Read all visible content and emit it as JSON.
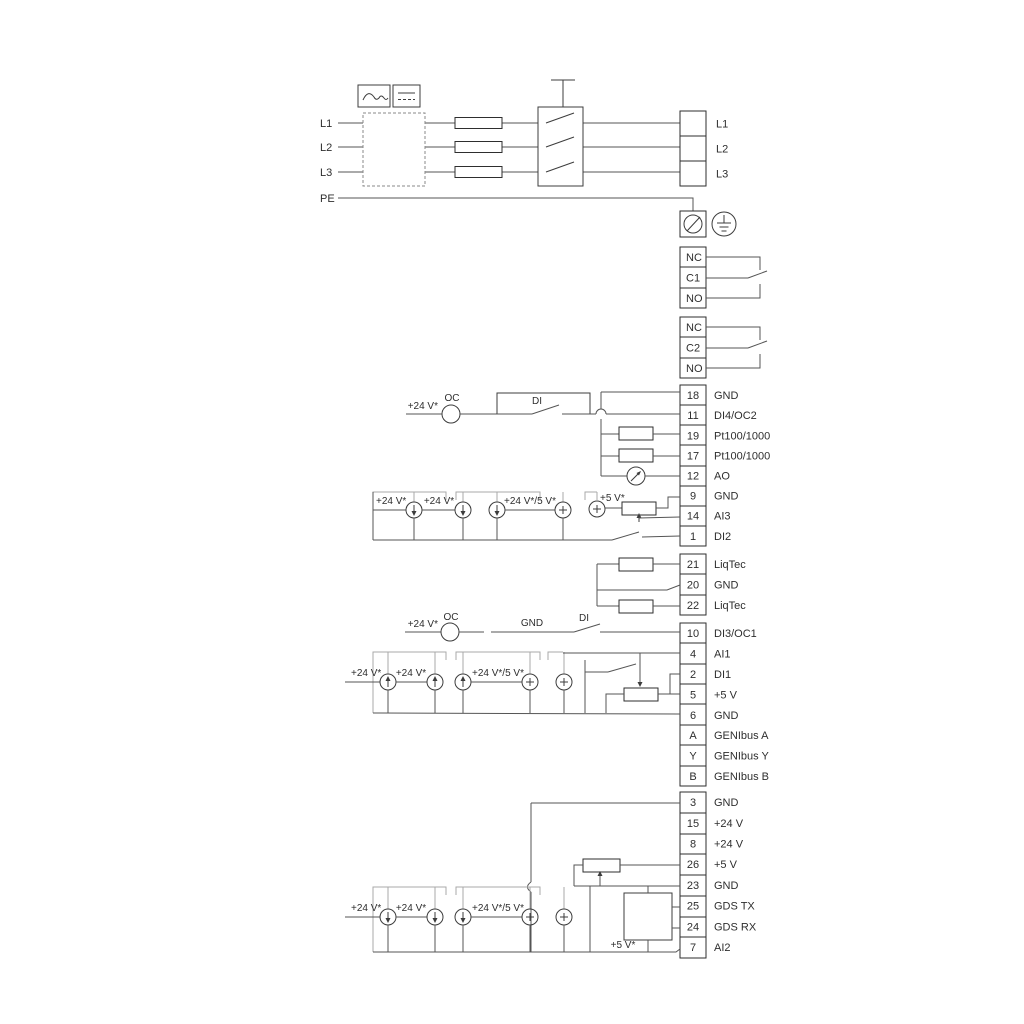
{
  "colors": {
    "background": "#ffffff",
    "wire": "#555555",
    "rail": "#a9a9a9",
    "text": "#2e2e2e"
  },
  "power": {
    "left_labels": [
      "L1",
      "L2",
      "L3",
      "PE"
    ],
    "mains_terminal_labels": [
      "L1",
      "L2",
      "L3"
    ]
  },
  "relay1": {
    "pins": [
      "NC",
      "C1",
      "NO"
    ]
  },
  "relay2": {
    "pins": [
      "NC",
      "C2",
      "NO"
    ]
  },
  "io_top": {
    "rows": [
      {
        "pin": "18",
        "label": "GND"
      },
      {
        "pin": "11",
        "label": "DI4/OC2"
      },
      {
        "pin": "19",
        "label": "Pt100/1000"
      },
      {
        "pin": "17",
        "label": "Pt100/1000"
      },
      {
        "pin": "12",
        "label": "AO"
      },
      {
        "pin": "9",
        "label": "GND"
      },
      {
        "pin": "14",
        "label": "AI3"
      },
      {
        "pin": "1",
        "label": "DI2"
      }
    ]
  },
  "liqtec": {
    "rows": [
      {
        "pin": "21",
        "label": "LiqTec"
      },
      {
        "pin": "20",
        "label": "GND"
      },
      {
        "pin": "22",
        "label": "LiqTec"
      }
    ]
  },
  "io_mid": {
    "rows": [
      {
        "pin": "10",
        "label": "DI3/OC1"
      },
      {
        "pin": "4",
        "label": "AI1"
      },
      {
        "pin": "2",
        "label": "DI1"
      },
      {
        "pin": "5",
        "label": "+5 V"
      },
      {
        "pin": "6",
        "label": "GND"
      },
      {
        "pin": "A",
        "label": "GENIbus A"
      },
      {
        "pin": "Y",
        "label": "GENIbus Y"
      },
      {
        "pin": "B",
        "label": "GENIbus B"
      }
    ]
  },
  "io_bottom": {
    "rows": [
      {
        "pin": "3",
        "label": "GND"
      },
      {
        "pin": "15",
        "label": "+24 V"
      },
      {
        "pin": "8",
        "label": "+24 V"
      },
      {
        "pin": "26",
        "label": "+5 V"
      },
      {
        "pin": "23",
        "label": "GND"
      },
      {
        "pin": "25",
        "label": "GDS TX"
      },
      {
        "pin": "24",
        "label": "GDS RX"
      },
      {
        "pin": "7",
        "label": "AI2"
      }
    ]
  },
  "sec_a": {
    "plus24": "+24 V*",
    "oc": "OC",
    "di": "DI"
  },
  "row_a": {
    "s1": "+24 V*",
    "s2": "+24 V*",
    "s3": "+24 V*/5 V*",
    "s4": "+5 V*"
  },
  "sec_b": {
    "plus24": "+24 V*",
    "oc": "OC",
    "gnd": "GND",
    "di": "DI"
  },
  "row_b": {
    "s1": "+24 V*",
    "s2": "+24 V*",
    "s3": "+24 V*/5 V*"
  },
  "row_c": {
    "s1": "+24 V*",
    "s2": "+24 V*",
    "s3": "+24 V*/5 V*",
    "s4": "+5 V*"
  }
}
